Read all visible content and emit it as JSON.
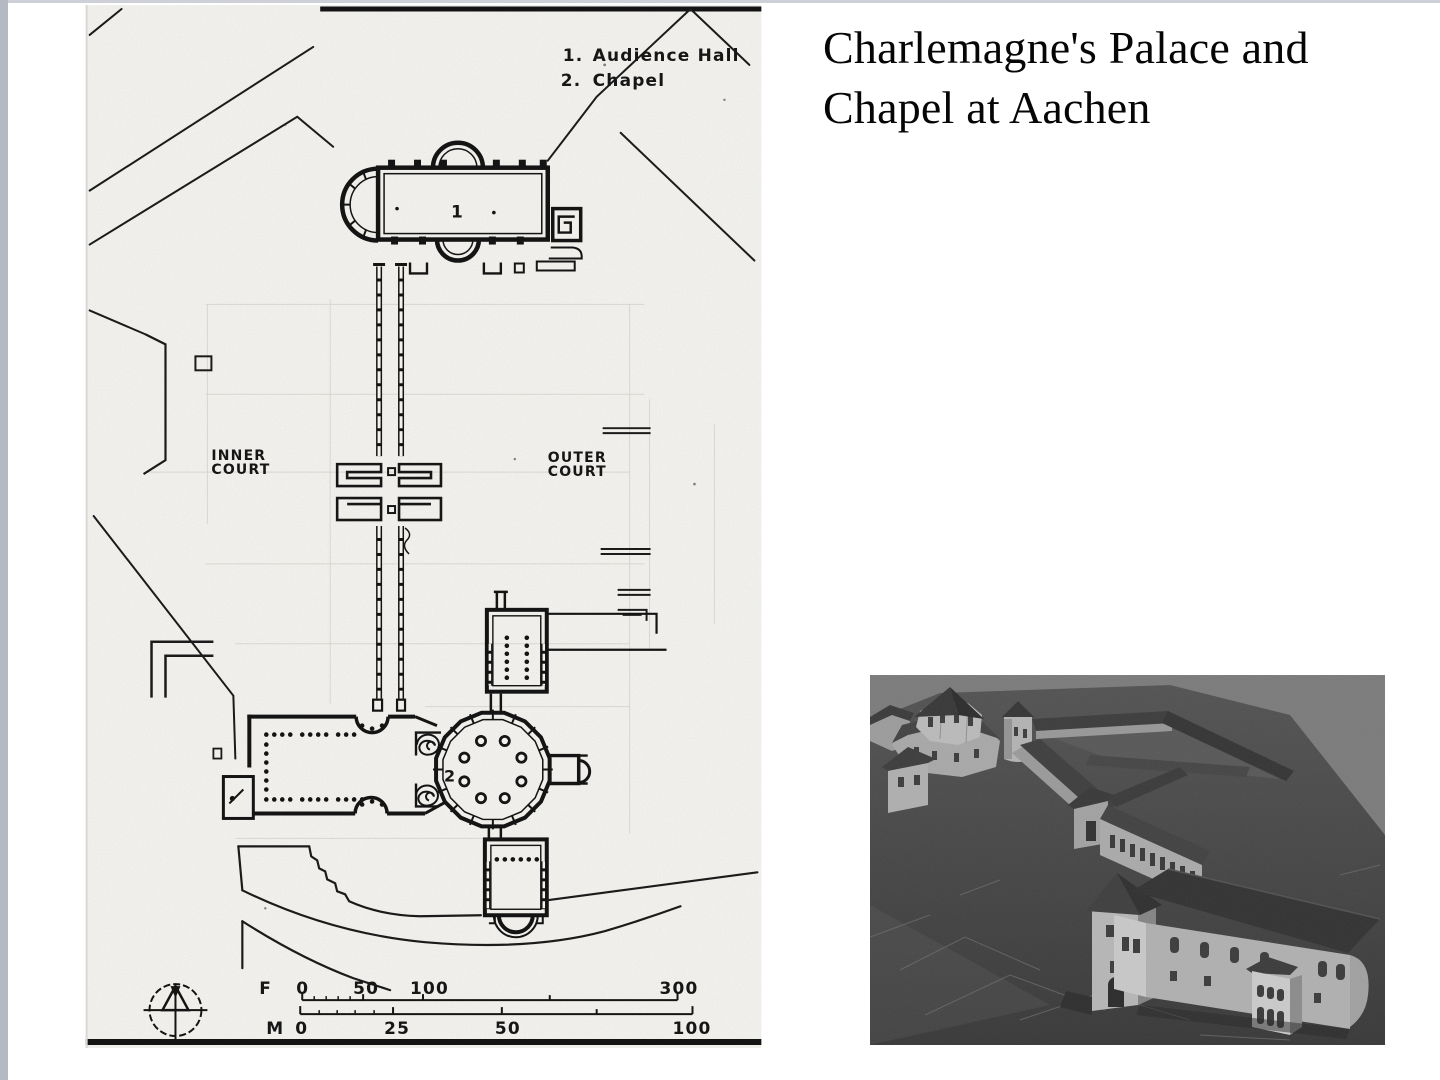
{
  "slide": {
    "title": "Charlemagne's Palace and Chapel at Aachen",
    "background": "#ffffff",
    "gutter_color": "#b5b9c1",
    "top_rule_color": "#cdd1d7"
  },
  "plan": {
    "legend": {
      "items": [
        {
          "num": "1.",
          "label": "Audience Hall"
        },
        {
          "num": "2.",
          "label": "Chapel"
        }
      ]
    },
    "marks": {
      "hall": "1",
      "chapel": "2"
    },
    "courts": {
      "inner": {
        "line1": "INNER",
        "line2": "COURT"
      },
      "outer": {
        "line1": "OUTER",
        "line2": "COURT"
      }
    },
    "scalebars": {
      "feet": {
        "unit": "F",
        "t0": "0",
        "t50": "50",
        "t100": "100",
        "t300": "300"
      },
      "meters": {
        "unit": "M",
        "t0": "0",
        "t25": "25",
        "t50": "50",
        "t100": "100"
      }
    },
    "ink": "#161616",
    "paper": "#f3f2ee"
  },
  "photo": {
    "backdrop": "#7a7a7a"
  }
}
